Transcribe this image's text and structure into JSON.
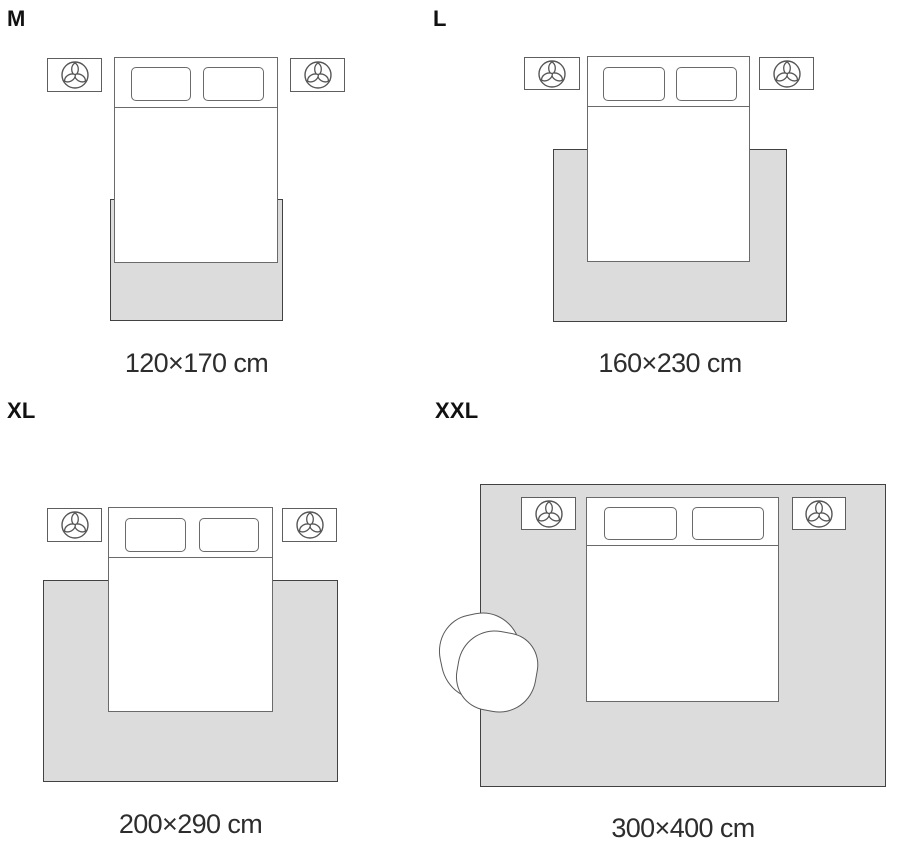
{
  "sizes": [
    {
      "label": "M",
      "caption": "120×170 cm"
    },
    {
      "label": "L",
      "caption": "160×230 cm"
    },
    {
      "label": "XL",
      "caption": "200×290 cm"
    },
    {
      "label": "XXL",
      "caption": "300×400 cm"
    }
  ],
  "icons": {
    "nightstand": "plant-icon"
  },
  "colors": {
    "background": "#ffffff",
    "rug_fill": "#dcdcdc",
    "rug_border": "#424242",
    "furniture_border": "#6a6a6a",
    "text": "#2d2d2d",
    "label_text": "#111111"
  }
}
